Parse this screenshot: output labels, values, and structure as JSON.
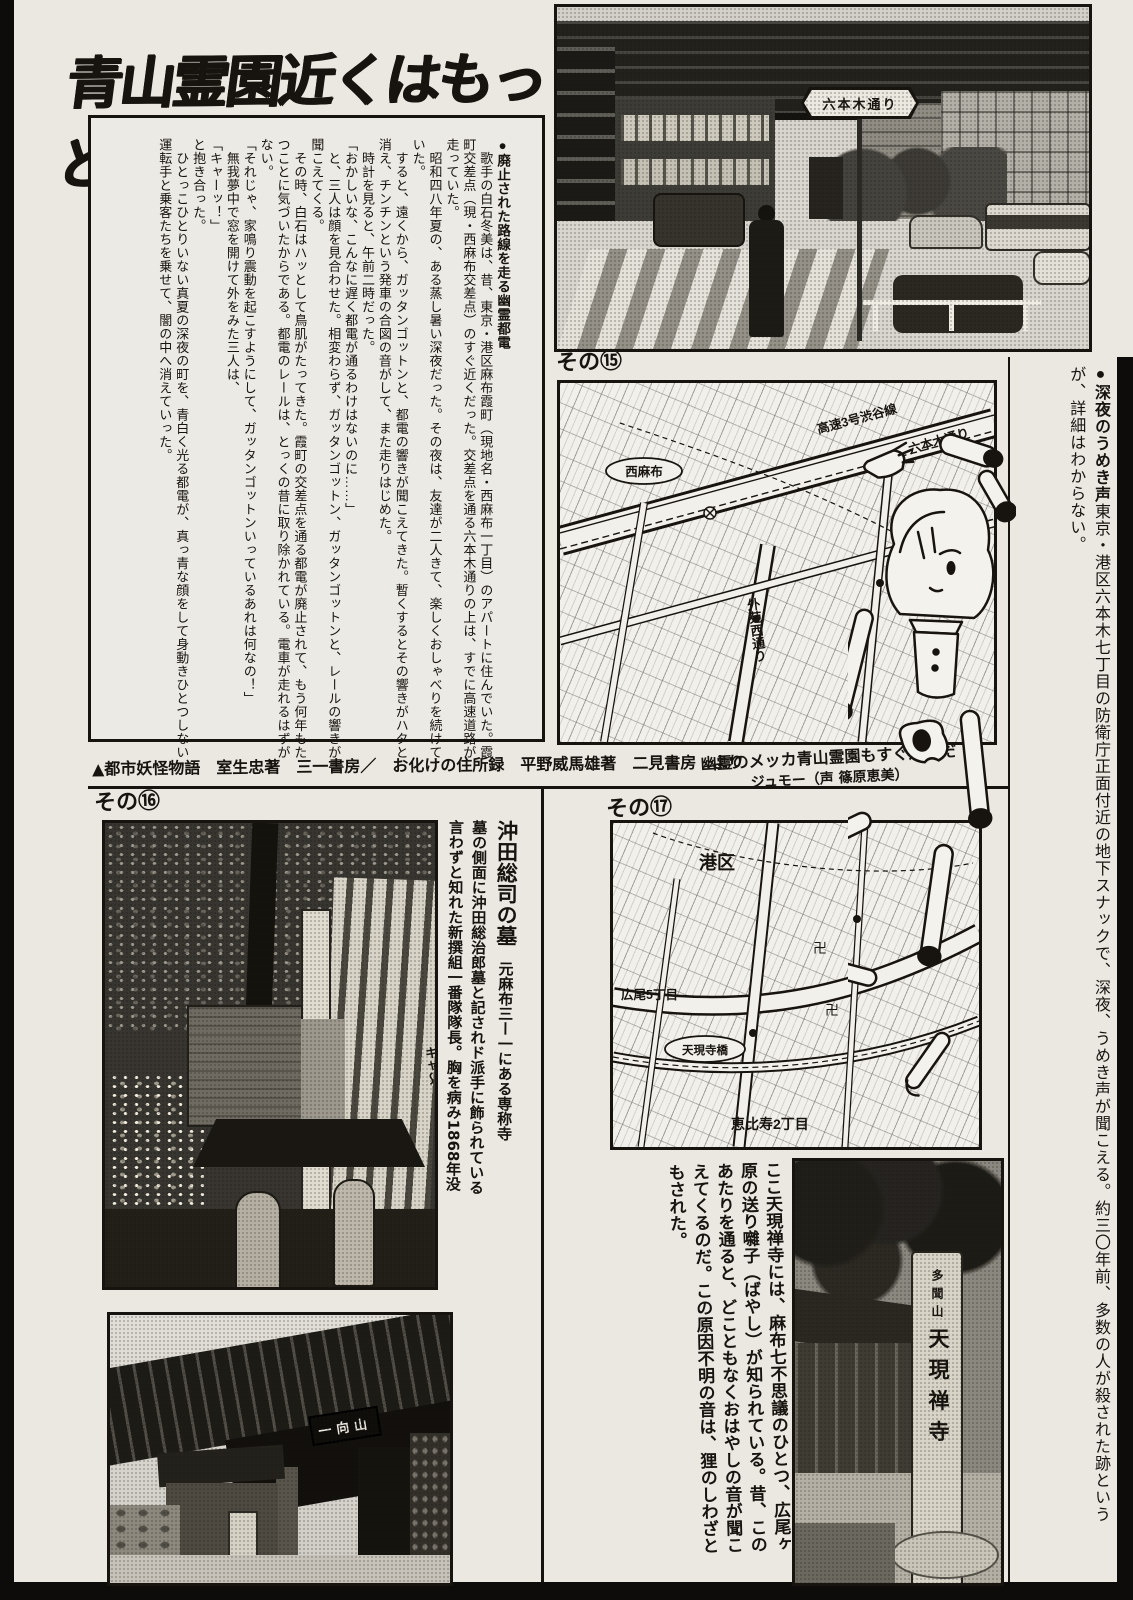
{
  "page": {
    "title": "青山霊園近くはもっと怖い!"
  },
  "labels": {
    "photo15": "その⑮",
    "photo16": "その⑯",
    "map17": "その⑰"
  },
  "story": {
    "heading": "●廃止された路線を走る幽霊都電",
    "body": "\n　歌手の白石冬美は、昔、東京・港区麻布霞町（現地名・西麻布一丁目）のアパートに住んでいた。霞町交差点（現・西麻布交差点）のすぐ近くだった。交差点を通る六本木通りの上は、すでに高速道路が走っていた。\n　昭和四八年夏の、ある蒸し暑い深夜だった。その夜は、友達が二人きて、楽しくおしゃべりを続けていた。\n　すると、遠くから、ガッタンゴットンと、都電の響きが聞こえてきた。暫くするとその響きがハタと消え、チンチンという発車の合図の音がして、また走りはじめた。\n　時計を見ると、午前二時だった。\n「おかしいな、こんなに遅く都電が通るわけはないのに……」\n　と、三人は顔を見合わせた。相変わらず、ガッタンゴットン、ガッタンゴットンと、レールの響きが聞こえてくる。\n　その時、白石はハッとして鳥肌がたってきた。霞町の交差点を通る都電が廃止されて、もう何年もたつことに気づいたからである。都電のレールは、とっくの昔に取り除かれている。電車が走れるはずがない。\n「それじゃ、家鳴り震動を起こすようにして、ガッタンゴットンいっているあれは何なの！」\n　無我夢中で窓を開けて外をみた三人は、\n「キャーッ！」\nと抱き合った。\n　ひとっこひとりいない真夏の深夜の町を、青白く光る都電が、真っ青な顔をして身動きひとつしない運転手と乗客たちを乗せて、闇の中へ消えていった。"
  },
  "credit": {
    "text": "▲都市妖怪物語　室生忠著　三一書房／　お化けの住所録　平野威馬雄著　二見書房　より"
  },
  "doll_caption": {
    "line1": "幽霊のメッカ青山霊園もすぐ近くだ",
    "line2": "ジュモー（声 篠原恵美）"
  },
  "sidebar": {
    "heading": "●深夜のうめき声",
    "body": "東京・港区六本木七丁目の防衛庁正面付近の地下スナックで、深夜、うめき声が聞こえる。約三〇年前、多数の人が殺された跡というが、詳細はわからない。"
  },
  "street_photo": {
    "sign": "六本木通り"
  },
  "map15": {
    "hwy": "高速3号渋谷線",
    "roppongi": "六本木通り",
    "nishiazabu": "西麻布",
    "gaien": "外苑西通り"
  },
  "map17": {
    "ward": "港区",
    "hiroo": "広尾5丁目",
    "bridge": "天現寺橋",
    "ebisu": "恵比寿2丁目",
    "temple_mark": "卍"
  },
  "okita": {
    "title": "沖田総司の墓",
    "body": "　元麻布三ー一にある専称寺\n墓の側面に沖田総治郎墓と記されド派手に飾られている\n言わずと知れた新撰組一番隊隊長。胸を病み1868年没",
    "scream": "キャ〜"
  },
  "tengen": {
    "body": "ここ天現禅寺には、麻布七不思議のひとつ、広尾ヶ原の送り囃子（ばやし）が知られている。昔、このあたりを通ると、どこともなくおはやしの音が聞こえてくるのだ。この原因不明の音は、狸のしわざともされた。"
  },
  "gate_photo": {
    "plaque": "一向山"
  },
  "temple_photo": {
    "pillar_top": "多聞山",
    "pillar_main": "天現禅寺"
  }
}
